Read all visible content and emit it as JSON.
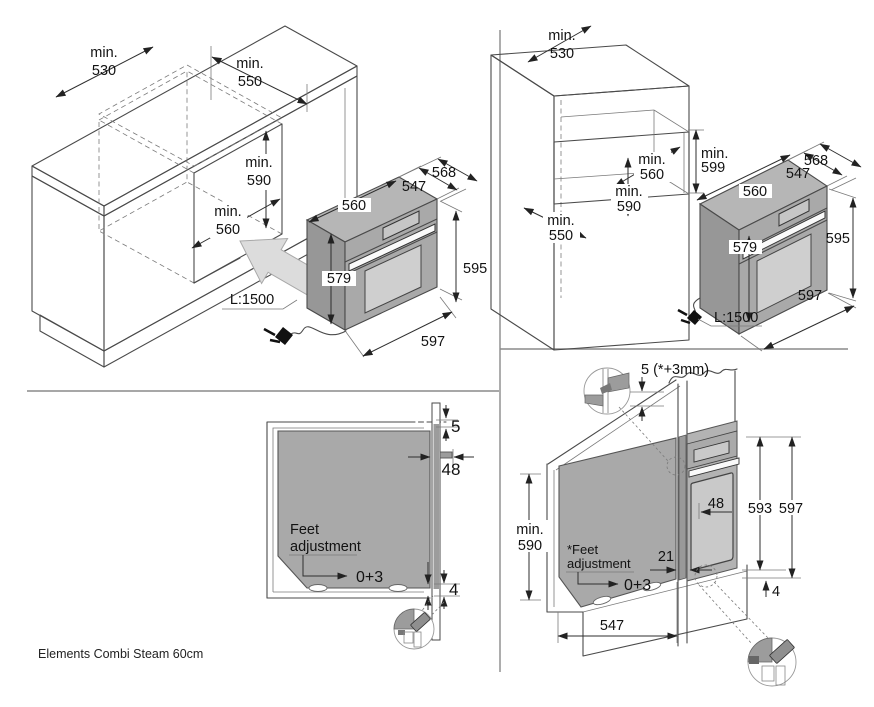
{
  "footer": {
    "model": "Elements Combi Steam 60cm"
  },
  "colors": {
    "line": "#4a4a4a",
    "divider": "#8a8a8a",
    "oven_body": "#a9a9a9",
    "oven_top": "#b6b6b6",
    "oven_side": "#979797",
    "door_glass": "#cfcfcf",
    "handle": "#fafafa",
    "insert_arrow": "#dcdcdc",
    "detail_gray": "#9c9c9c"
  },
  "under_counter": {
    "min530_1": "min.",
    "min530_2": "530",
    "min550_1": "min.",
    "min550_2": "550",
    "min590_1": "min.",
    "min590_2": "590",
    "min560_1": "min.",
    "min560_2": "560",
    "depth_total": "568",
    "depth_body": "547",
    "width_body": "560",
    "height_body": "579",
    "height_total": "595",
    "width_total": "597",
    "cord": "L:1500"
  },
  "tall_cabinet": {
    "min530_1": "min.",
    "min530_2": "530",
    "min599_1": "min.",
    "min599_2": "599",
    "min560_1": "min.",
    "min560_2": "560",
    "min590_1": "min.",
    "min590_2": "590",
    "min550_1": "min.",
    "min550_2": "550",
    "depth_total": "568",
    "depth_body": "547",
    "width_body": "560",
    "height_body": "579",
    "height_total": "595",
    "width_total": "597",
    "cord": "L:1500"
  },
  "side_section": {
    "top_gap": "5",
    "door_depth": "48",
    "feet_1": "Feet",
    "feet_2": "adjustment",
    "feet_range": "0+3",
    "bottom_gap": "4"
  },
  "column_section": {
    "top_gap": "5 (*+3mm)",
    "min590_1": "min.",
    "min590_2": "590",
    "feet_1": "*Feet",
    "feet_2": "adjustment",
    "feet_range": "0+3",
    "niche_depth": "547",
    "door_depth": "48",
    "wall_offset": "21",
    "height_inner": "593",
    "height_outer": "597",
    "bottom_gap": "4"
  }
}
